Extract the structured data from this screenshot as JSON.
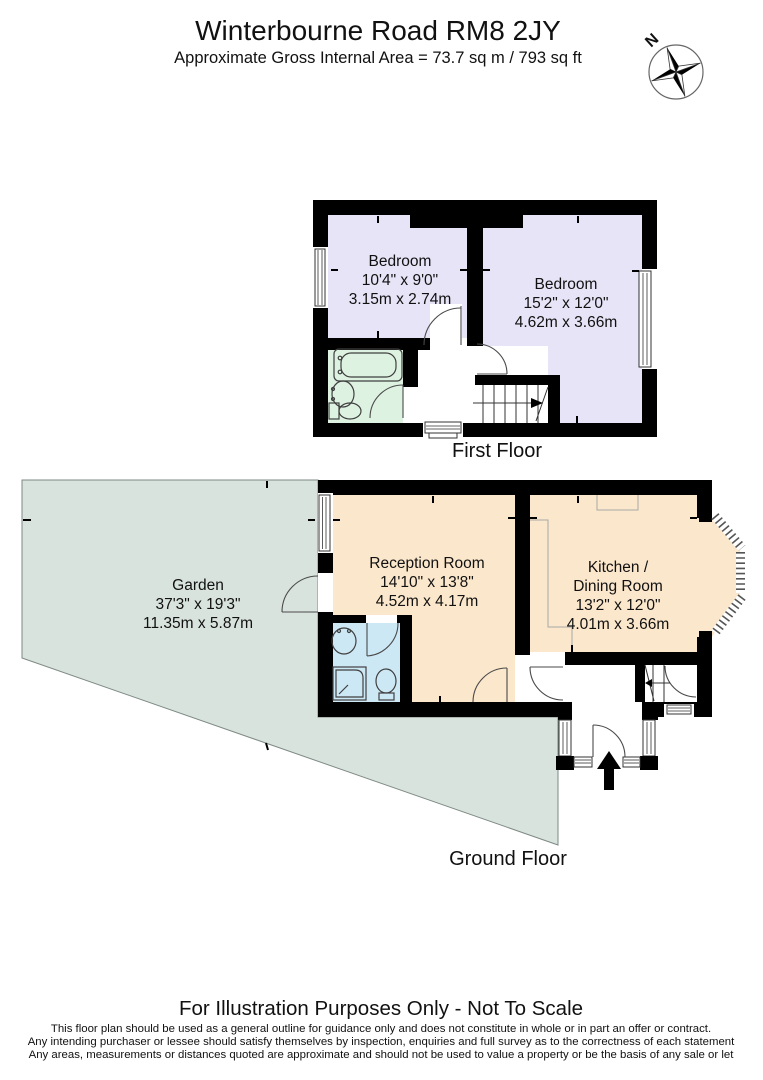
{
  "header": {
    "title": "Winterbourne Road RM8 2JY",
    "subtitle": "Approximate Gross Internal Area = 73.7 sq m / 793 sq ft",
    "compass_label": "N"
  },
  "first_floor": {
    "label": "First Floor",
    "bedroom1": {
      "name": "Bedroom",
      "dims_imperial": "10'4\" x 9'0\"",
      "dims_metric": "3.15m x 2.74m"
    },
    "bedroom2": {
      "name": "Bedroom",
      "dims_imperial": "15'2\" x 12'0\"",
      "dims_metric": "4.62m x 3.66m"
    }
  },
  "ground_floor": {
    "label": "Ground Floor",
    "reception": {
      "name": "Reception Room",
      "dims_imperial": "14'10\" x 13'8\"",
      "dims_metric": "4.52m x 4.17m"
    },
    "kitchen": {
      "name_line1": "Kitchen /",
      "name_line2": "Dining Room",
      "dims_imperial": "13'2\" x 12'0\"",
      "dims_metric": "4.01m x 3.66m"
    },
    "garden": {
      "name": "Garden",
      "dims_imperial": "37'3\" x 19'3\"",
      "dims_metric": "11.35m x 5.87m"
    }
  },
  "footer": {
    "heading": "For Illustration Purposes Only - Not To Scale",
    "disclaimer_lines": [
      "This floor plan should be used as a general outline for guidance only and does not constitute in whole or in part an offer or contract.",
      "Any intending purchaser or lessee should satisfy themselves by inspection, enquiries and full survey as to the correctness of each statement",
      "Any areas, measurements or distances quoted are approximate and should not be used to value a property or be the basis of any sale or let"
    ]
  },
  "colors": {
    "room_peach": "#FBE7CB",
    "bedroom_lavender": "#E6E4F6",
    "bathroom_mint": "#DEF2E2",
    "wc_blue": "#CDE8F5",
    "garden_green": "#D9E3DD",
    "wall_black": "#000000"
  }
}
